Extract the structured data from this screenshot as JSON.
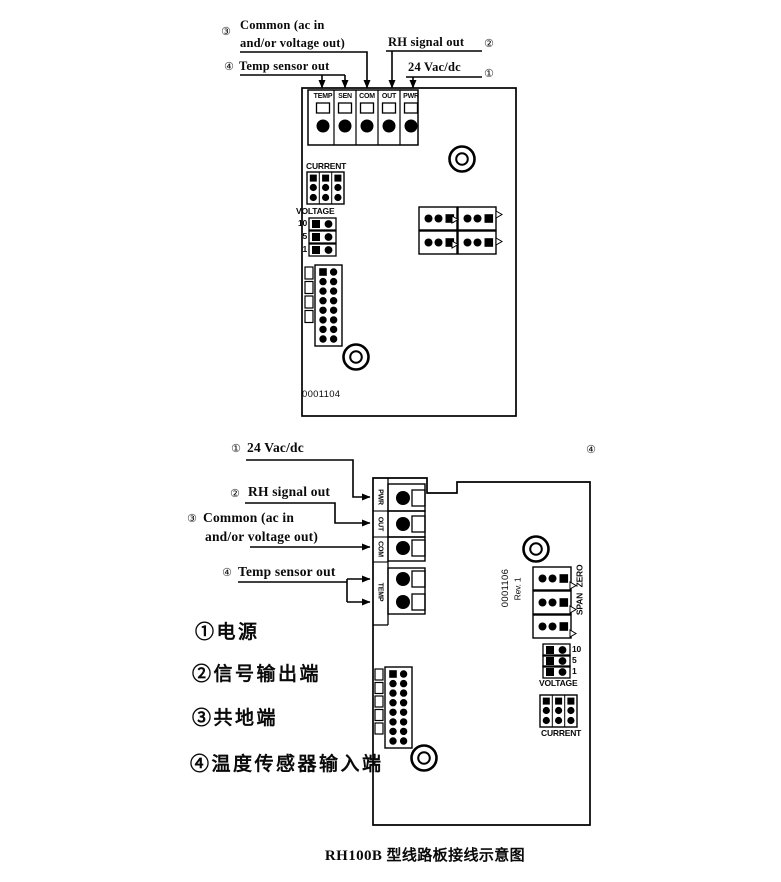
{
  "caption": "RH100B 型线路板接线示意图",
  "top": {
    "annotations": {
      "common_num": "③",
      "common1": "Common (ac in",
      "common2": "and/or voltage out)",
      "temp_num": "④",
      "temp": "Temp sensor out",
      "rh": "RH signal out",
      "rh_num": "②",
      "power": "24 Vac/dc",
      "power_num": "①"
    },
    "board": {
      "terminals": [
        "TEMP",
        "SEN",
        "COM",
        "OUT",
        "PWR"
      ],
      "current": "CURRENT",
      "voltage": "VOLTAGE",
      "voltage_taps": [
        "10",
        "5",
        "1"
      ],
      "part_number": "0001104"
    }
  },
  "bottom": {
    "annotations": {
      "power_num": "①",
      "power": "24 Vac/dc",
      "rh_num": "②",
      "rh": "RH signal out",
      "common_num": "③",
      "common1": "Common (ac in",
      "common2": "and/or voltage out)",
      "temp_num": "④",
      "temp": "Temp sensor out",
      "corner_num": "④"
    },
    "legend": [
      "①电源",
      "②信号输出端",
      "③共地端",
      "④温度传感器输入端"
    ],
    "board": {
      "terminals": [
        "PWR",
        "OUT",
        "COM",
        "TEMP"
      ],
      "part_number": "0001106",
      "revision": "Rev. 1",
      "zero": "ZERO",
      "span": "SPAN",
      "voltage": "VOLTAGE",
      "voltage_taps": [
        "10",
        "5",
        "1"
      ],
      "current": "CURRENT"
    }
  }
}
